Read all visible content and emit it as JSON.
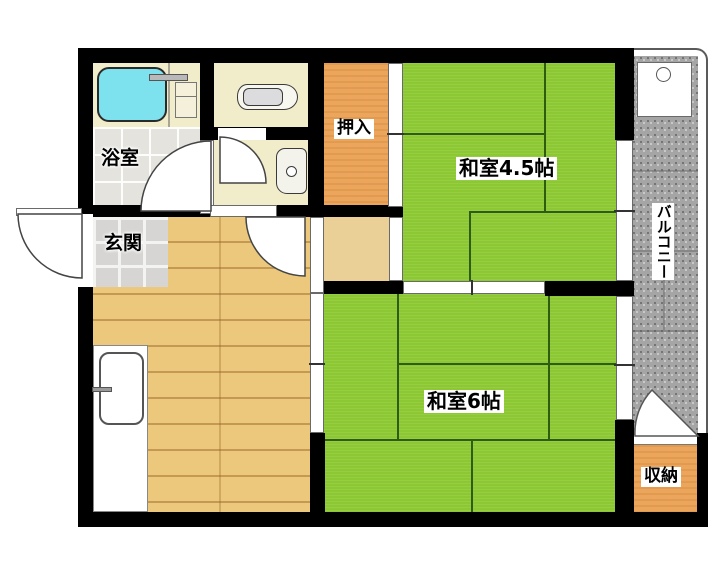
{
  "labels": {
    "bath": "浴室",
    "entrance": "玄関",
    "closet": "押入",
    "room45": "和室4.5帖",
    "room6": "和室6帖",
    "balcony": "バルコニー",
    "storage": "収納"
  },
  "colors": {
    "wall": "#000000",
    "tatami_green": "#8cc832",
    "tatami_seam": "#2e5c10",
    "wood_floor": "#ebc87c",
    "closet_orange": "#eba55c",
    "cream_floor": "#f1ecca",
    "balcony_gray": "#a5a5a5",
    "bathtub_cyan": "#7de2ee",
    "tile_gray": "#d6d5d3"
  }
}
